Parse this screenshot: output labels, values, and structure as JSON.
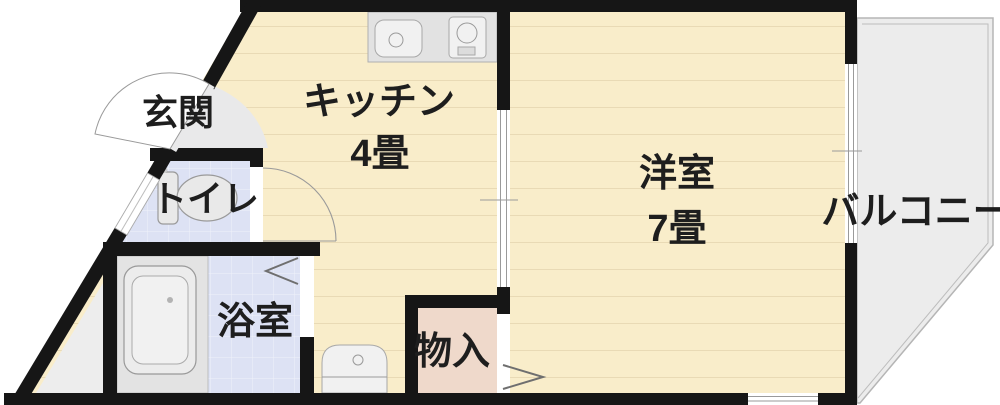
{
  "plan": {
    "rooms": [
      {
        "id": "genkan",
        "name": "玄関"
      },
      {
        "id": "kitchen",
        "name": "キッチン",
        "size": "4畳"
      },
      {
        "id": "western",
        "name": "洋室",
        "size": "7畳"
      },
      {
        "id": "toilet",
        "name": "トイレ"
      },
      {
        "id": "bathroom",
        "name": "浴室"
      },
      {
        "id": "storage",
        "name": "物入"
      },
      {
        "id": "balcony",
        "name": "バルコニー"
      }
    ],
    "colors": {
      "wall": "#161616",
      "floor": "#f9edca",
      "wet_room": "#dde2f4",
      "storage": "#efd9cb",
      "balcony": "#ececec",
      "entry_step": "#e9e9ea",
      "void_space": "#ededed",
      "fixture_panel": "#e3e3e3"
    }
  }
}
